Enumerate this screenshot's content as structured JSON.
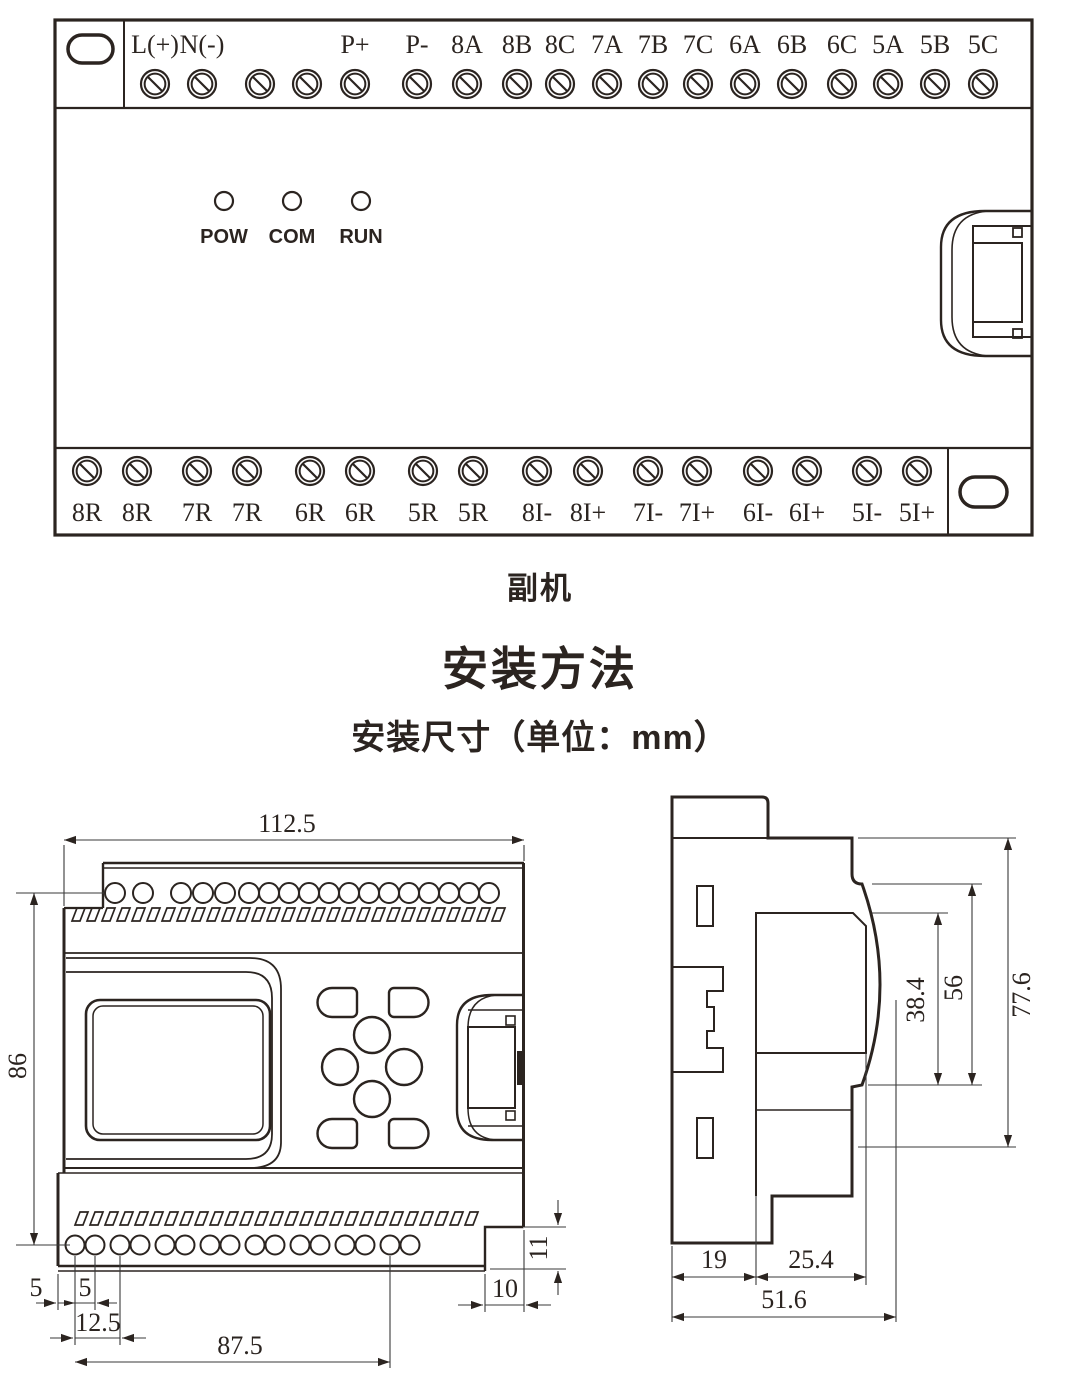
{
  "panel": {
    "caption": "副机",
    "leds": [
      "POW",
      "COM",
      "RUN"
    ],
    "top_terminals": [
      "L(+)",
      "N(-)",
      "",
      "",
      "P+",
      "P-",
      "8A",
      "8B",
      "8C",
      "7A",
      "7B",
      "7C",
      "6A",
      "6B",
      "6C",
      "5A",
      "5B",
      "5C"
    ],
    "bottom_terminals": [
      "8R",
      "8R",
      "7R",
      "7R",
      "6R",
      "6R",
      "5R",
      "5R",
      "8I-",
      "8I+",
      "7I-",
      "7I+",
      "6I-",
      "6I+",
      "5I-",
      "5I+"
    ]
  },
  "headings": {
    "title": "安装方法",
    "subtitle": "安装尺寸（单位：mm）"
  },
  "front_view": {
    "dims": {
      "width": "112.5",
      "height": "86",
      "edge_to_hole": "5",
      "hole_pair_gap": "5",
      "pair_pitch": "12.5",
      "hole_span": "87.5",
      "notch_width": "10",
      "notch_height": "11"
    }
  },
  "side_view": {
    "dims": {
      "front_face": "38.4",
      "front_section": "56",
      "height": "77.6",
      "back_step": "19",
      "mid_step": "25.4",
      "depth": "51.6"
    }
  },
  "colors": {
    "line": "#2b2420",
    "background": "#ffffff"
  }
}
